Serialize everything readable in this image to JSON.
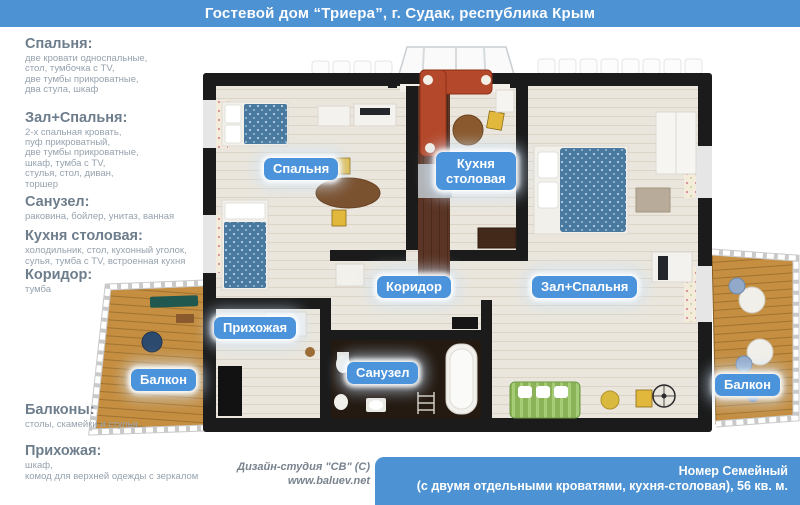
{
  "header": {
    "title": "Гостевой дом “Триера”, г. Судак, республика Крым"
  },
  "legend": [
    {
      "heading": "Спальня:",
      "lines": [
        "две кровати односпальные,",
        "стол, тумбочка с TV,",
        "две тумбы прикроватные,",
        "два стула, шкаф"
      ]
    },
    {
      "heading": "Зал+Спальня:",
      "lines": [
        "2-х спальная кровать,",
        "пуф прикроватный,",
        "две тумбы прикроватные,",
        "шкаф, тумба с TV,",
        "стулья, стол, диван,",
        "торшер"
      ]
    },
    {
      "heading": "Санузел:",
      "lines": [
        "раковина, бойлер, унитаз, ванная"
      ]
    },
    {
      "heading": "Кухня столовая:",
      "lines": [
        "холодильник, стол, кухонный уголок,",
        "сулья, тумба с TV, встроенная кухня"
      ]
    },
    {
      "heading": "Коридор:",
      "lines": [
        "тумба"
      ]
    },
    {
      "heading": "Балконы:",
      "lines": [
        "столы, скамейки и стулья"
      ]
    },
    {
      "heading": "Прихожая:",
      "lines": [
        "шкаф,",
        "комод для верхней одежды с зеркалом"
      ]
    }
  ],
  "rooms": {
    "bedroom": "Спальня",
    "kitchen_line1": "Кухня",
    "kitchen_line2": "столовая",
    "corridor": "Коридор",
    "hall": "Зал+Спальня",
    "entry": "Прихожая",
    "bathroom": "Санузел",
    "balcony_left": "Балкон",
    "balcony_right": "Балкон"
  },
  "credit": {
    "studio": "Дизайн-студия \"СВ\" (С)",
    "site": "www.baluev.net"
  },
  "caption": {
    "line1": "Номер Семейный",
    "line2": "(с двумя отдельными кроватями, кухня-столовая), 56 кв. м."
  },
  "colors": {
    "accent_blue": "#4d92d3",
    "label_blue": "#4b93da",
    "heading_gray": "#6d7d8c",
    "body_gray": "#96a2ae",
    "wall_black": "#1b1b1b",
    "floor_beige": "#eae6dd",
    "balcony_wood": "#c58e41",
    "kitchen_wood": "#5a3424",
    "sofa_red": "#b4482a",
    "sofa_green": "#8ab357",
    "bed_blue": "#49799f"
  }
}
